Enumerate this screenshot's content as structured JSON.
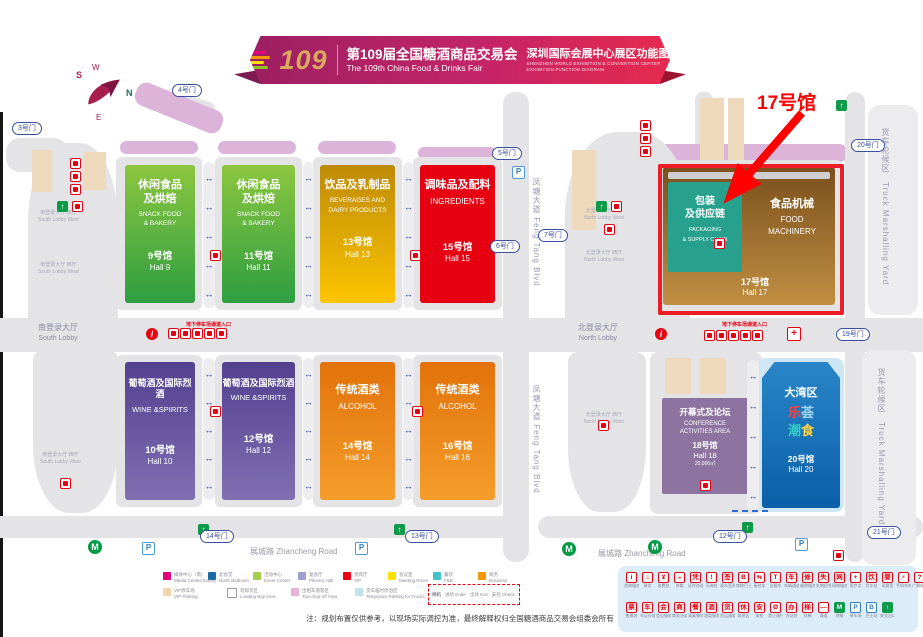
{
  "banner": {
    "logo_number": "109",
    "title_cn": "第109届全国糖酒商品交易会",
    "title_en": "The 109th China Food & Drinks Fair",
    "subtitle_cn": "深圳国际会展中心展区功能图",
    "subtitle_en_1": "SHENZHEN WORLD EXHIBITION & CONVENTION CENTER",
    "subtitle_en_2": "EXHIBITION FUNCTION DIAGRAM"
  },
  "annotation": {
    "label": "17号馆",
    "color": "#ff0000"
  },
  "compass": {
    "n": "N",
    "s": "S",
    "e": "E",
    "w": "W"
  },
  "halls": {
    "h9": {
      "cn": "休闲食品\n及烘焙",
      "en1": "SNACK FOOD",
      "en2": "& BAKERY",
      "num": "9号馆",
      "name": "Hall 9",
      "color": "#2e9e41"
    },
    "h11": {
      "cn": "休闲食品\n及烘焙",
      "en1": "SNACK FOOD",
      "en2": "& BAKERY",
      "num": "11号馆",
      "name": "Hall 11",
      "color": "#2e9e41"
    },
    "h13": {
      "cn": "饮品及乳制品",
      "en1": "BEVERAGES AND",
      "en2": "DAIRY PRODUCTS",
      "num": "13号馆",
      "name": "Hall 13",
      "color": "#fdc500"
    },
    "h15": {
      "cn": "调味品及配料",
      "en1": "INGREDIENTS",
      "en2": "",
      "num": "15号馆",
      "name": "Hall 15",
      "color": "#e60012"
    },
    "h10": {
      "cn": "葡萄酒及国际烈酒",
      "en1": "WINE &SPIRITS",
      "en2": "",
      "num": "10号馆",
      "name": "Hall 10",
      "color": "#53408f"
    },
    "h12": {
      "cn": "葡萄酒及国际烈酒",
      "en1": "WINE &SPIRITS",
      "en2": "",
      "num": "12号馆",
      "name": "Hall 12",
      "color": "#53408f"
    },
    "h14": {
      "cn": "传统酒类",
      "en1": "ALCOHOL",
      "en2": "",
      "num": "14号馆",
      "name": "Hall 14",
      "color": "#e1720a"
    },
    "h16": {
      "cn": "传统酒类",
      "en1": "ALCOHOL",
      "en2": "",
      "num": "16号馆",
      "name": "Hall 16",
      "color": "#e1720a"
    },
    "h17": {
      "left_cn1": "包装",
      "left_cn2": "及供应链",
      "left_en1": "PACKAGING",
      "left_en2": "& SUPPLY CHAIN",
      "right_cn": "食品机械",
      "right_en1": "FOOD",
      "right_en2": "MACHINERY",
      "num": "17号馆",
      "name": "Hall 17",
      "left_color": "#27a08e",
      "right_color": "#8a5a20"
    },
    "h18": {
      "cn": "开幕式及论坛",
      "en1": "CONFERENCE",
      "en2": "ACTIVITIES AREA",
      "num": "18号馆",
      "name": "Hall 18",
      "area": "20,000㎡",
      "color": "#8d74a0"
    },
    "h20": {
      "cn": "大湾区",
      "logo": [
        "乐",
        "荟",
        "潮",
        "食"
      ],
      "num": "20号馆",
      "name": "Hall 20",
      "color": "#0b5fa8"
    }
  },
  "gates": [
    "3号门",
    "4号门",
    "5号门",
    "6号门",
    "7号门",
    "20号门",
    "19号门",
    "14号门",
    "13号门",
    "12号门",
    "21号门"
  ],
  "roads": {
    "zhancheng": "展城路  Zhancheng Road",
    "fengtang": "凤塘大道   Feng Tang Blvd",
    "truck_cn": "货车轮候区",
    "truck_en": "Truck Marshalling Yard"
  },
  "lobbies": {
    "south_cn": "南登录大厅",
    "south_en": "South Lobby",
    "north_cn": "北登录大厅",
    "north_en": "North Lobby",
    "south_west_cn": "南登录大厅 西厅",
    "south_west_en": "South Lobby West",
    "north_west_cn": "北登录大厅 西厅",
    "north_west_en": "North Lobby West",
    "parking_entry": "地下停车场通道入口"
  },
  "legend_areas": [
    {
      "color": "#e5007d",
      "cn": "媒体中心（南）",
      "en": "Media Center(South)"
    },
    {
      "color": "#1c6ca8",
      "cn": "北会堂",
      "en": "North Ballroom"
    },
    {
      "color": "#a5cf4c",
      "cn": "活动中心",
      "en": "Event Center"
    },
    {
      "color": "#9f9fce",
      "cn": "宴会厅",
      "en": "Plenary Hall"
    },
    {
      "color": "#e60012",
      "cn": "贵宾厅",
      "en": "VIP"
    },
    {
      "color": "#ffe100",
      "cn": "会议室",
      "en": "Meeting Room"
    },
    {
      "color": "#45c2c8",
      "cn": "餐饮",
      "en": "F&B"
    },
    {
      "color": "#f39800",
      "cn": "商务",
      "en": "Business"
    },
    {
      "color": "#f2d5ae",
      "cn": "VIP停车场",
      "en": "VIP Parking"
    },
    {
      "color": "#ffffff",
      "cn": "装卸货区",
      "en": "Loading Bay Area"
    },
    {
      "color": "#e8b3d2",
      "cn": "出租车落客区",
      "en": "Taxi drop-off Area"
    },
    {
      "color": "#bfe3e8",
      "cn": "货车临时停泊区",
      "en": "Temporary Parking for Trucks"
    }
  ],
  "legend_gatebox": {
    "title": "闸机",
    "items": [
      {
        "cn": "进场",
        "en": "Enter"
      },
      {
        "cn": "出场",
        "en": "Exit"
      },
      {
        "cn": "安检",
        "en": "Check"
      }
    ]
  },
  "icon_legend": {
    "row1": [
      {
        "g": "i",
        "l": "咨询服务"
      },
      {
        "g": "♨",
        "l": "餐饮"
      },
      {
        "g": "¥",
        "l": "收费处"
      },
      {
        "g": "☕",
        "l": "茶歇"
      },
      {
        "g": "凭",
        "l": "证件办理"
      },
      {
        "g": "!",
        "l": "问询处"
      },
      {
        "g": "签",
        "l": "观众签到"
      },
      {
        "g": "B",
        "l": "穿梭巴士"
      },
      {
        "g": "⇆",
        "l": "接驳车"
      },
      {
        "g": "T",
        "l": "出租车"
      },
      {
        "g": "车",
        "l": "车辆通道"
      },
      {
        "g": "修",
        "l": "维修服务"
      },
      {
        "g": "失",
        "l": "失物招领"
      },
      {
        "g": "网",
        "l": "网络服务"
      },
      {
        "g": "+",
        "l": "医疗点"
      },
      {
        "g": "饮",
        "l": "饮水处"
      },
      {
        "g": "婴",
        "l": "母婴室"
      },
      {
        "g": "⚡",
        "l": "手机充电"
      },
      {
        "g": "?",
        "l": "广播服务"
      }
    ],
    "row2": [
      {
        "g": "票",
        "l": "售票处"
      },
      {
        "g": "车",
        "l": "车证办理"
      },
      {
        "g": "会",
        "l": "会议服务"
      },
      {
        "g": "商",
        "l": "商务洽谈"
      },
      {
        "g": "餐",
        "l": "清真餐饮"
      },
      {
        "g": "酒",
        "l": "酒类服务"
      },
      {
        "g": "货",
        "l": "货运通道"
      },
      {
        "g": "休",
        "l": "休息区"
      },
      {
        "g": "安",
        "l": "安检"
      },
      {
        "g": "Ø",
        "l": "禁止通行"
      },
      {
        "g": "办",
        "l": "办证处"
      },
      {
        "g": "梯",
        "l": "扶梯"
      },
      {
        "g": "—",
        "l": "通道"
      },
      {
        "g": "M",
        "l": "地铁",
        "c": "green"
      },
      {
        "g": "P",
        "l": "停车场",
        "c": "blue"
      },
      {
        "g": "B",
        "l": "巴士站",
        "c": "blue"
      },
      {
        "g": "↑",
        "l": "安全出口",
        "c": "green"
      }
    ]
  },
  "note": "注：规划布置仅供参考，以现场实际调控为准，最终解释权归全国糖酒商品交易会组委会所有"
}
